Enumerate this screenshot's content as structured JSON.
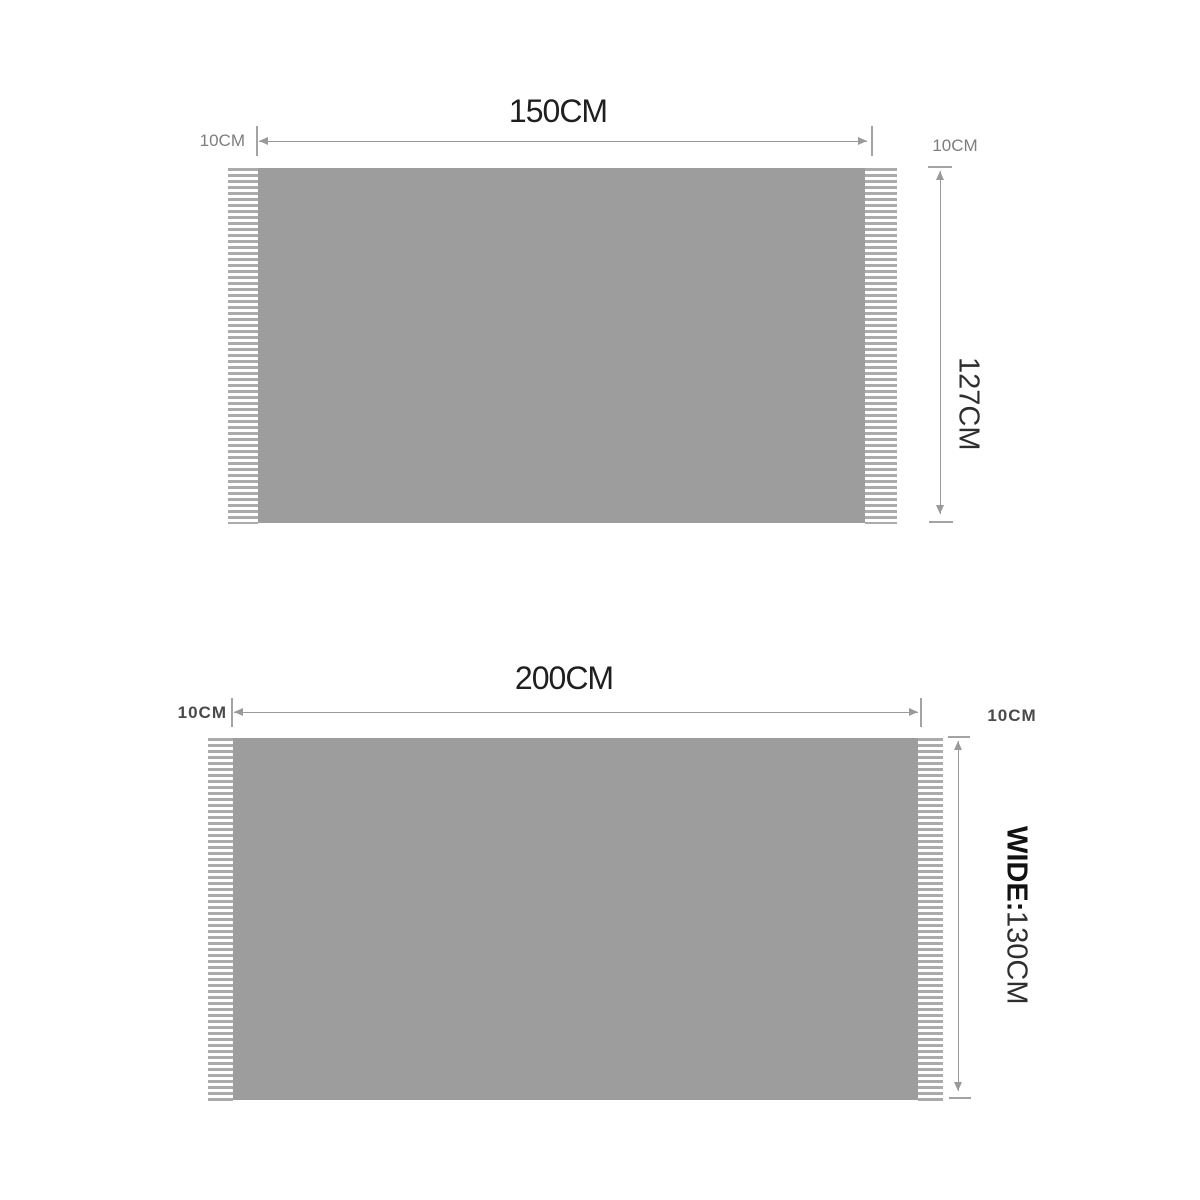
{
  "colors": {
    "background": "#ffffff",
    "blanket_fill": "#9d9d9d",
    "fringe_stripe": "#ababab",
    "dimension_line": "#9a9a9a",
    "title_text": "#1f1f1f",
    "fringe_label_gray": "#7e7e7e",
    "fringe_label_dark": "#4a4a4a"
  },
  "top_diagram": {
    "length_label": "150CM",
    "left_fringe_label": "10CM",
    "right_fringe_label": "10CM",
    "height_label": "127CM"
  },
  "bottom_diagram": {
    "length_label": "200CM",
    "left_fringe_label": "10CM",
    "right_fringe_label": "10CM",
    "height_label_prefix": "WIDE:",
    "height_label_value": "130CM"
  }
}
